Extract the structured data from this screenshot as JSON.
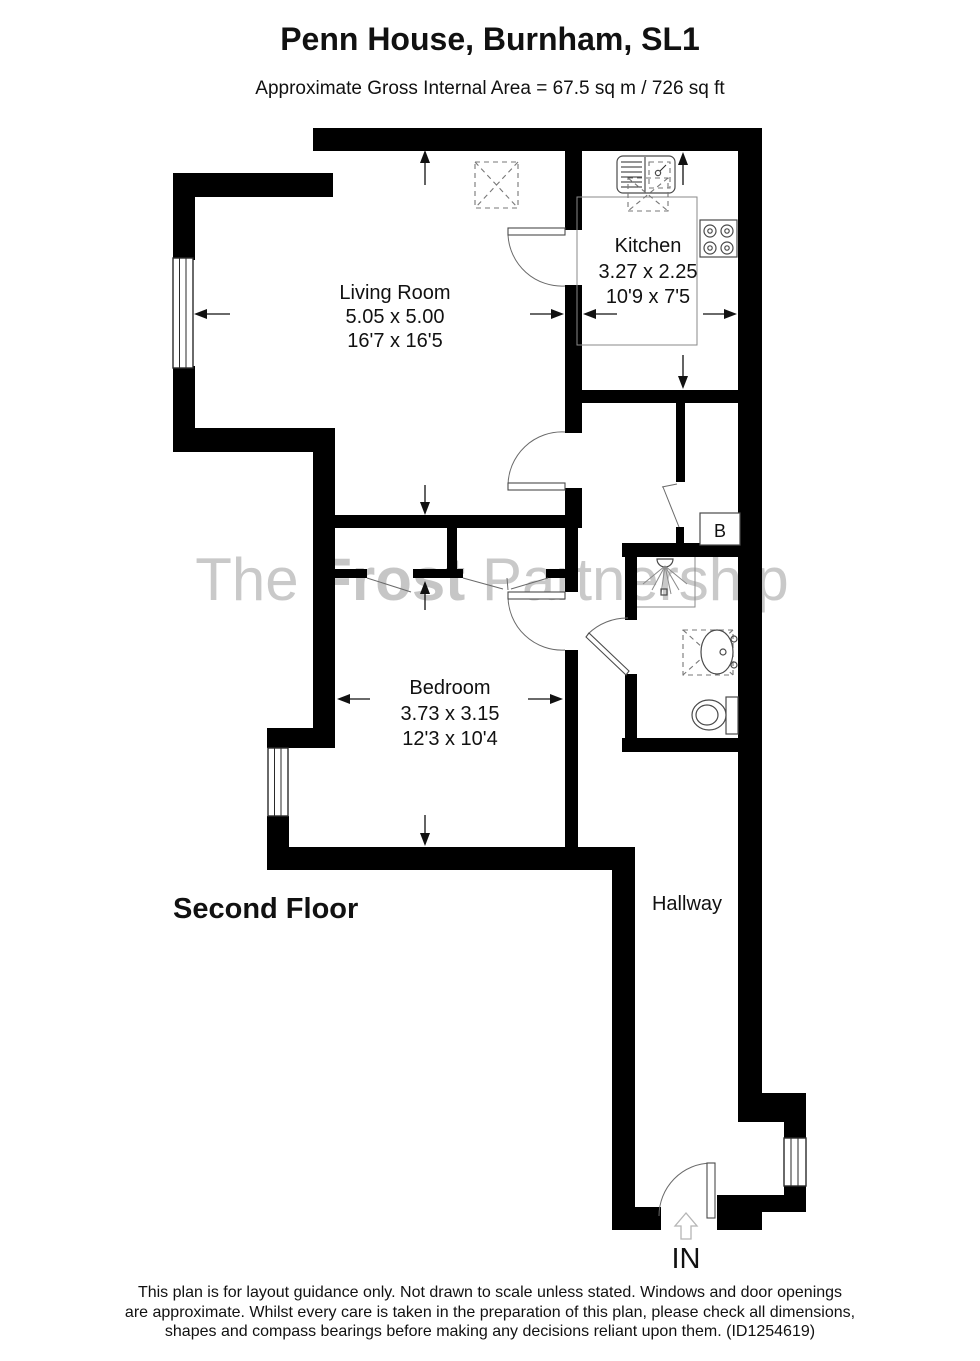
{
  "title": "Penn House, Burnham, SL1",
  "subtitle": "Approximate Gross Internal Area = 67.5 sq m / 726 sq ft",
  "floor_label": "Second Floor",
  "entrance_label": "IN",
  "watermark": {
    "word1": "The ",
    "word2": "Frost",
    "word3": " Partnership"
  },
  "rooms": {
    "living_room": {
      "name": "Living Room",
      "size_metric": "5.05 x 5.00",
      "size_imperial": "16'7 x 16'5"
    },
    "kitchen": {
      "name": "Kitchen",
      "size_metric": "3.27 x 2.25",
      "size_imperial": "10'9 x 7'5"
    },
    "bedroom": {
      "name": "Bedroom",
      "size_metric": "3.73 x 3.15",
      "size_imperial": "12'3 x 10'4"
    },
    "hallway": {
      "name": "Hallway"
    },
    "boiler": {
      "label": "B"
    }
  },
  "disclaimer": {
    "line1": "This plan is for layout guidance only. Not drawn to scale unless stated. Windows and door openings",
    "line2": "are approximate. Whilst every care is taken in the preparation of this plan, please check all dimensions,",
    "line3": "shapes and compass bearings before making any decisions reliant upon them. (ID1254619)"
  },
  "colors": {
    "wall": "#000000",
    "line": "#4a4a4a",
    "watermark": "#c9c9c9",
    "background": "#ffffff"
  }
}
